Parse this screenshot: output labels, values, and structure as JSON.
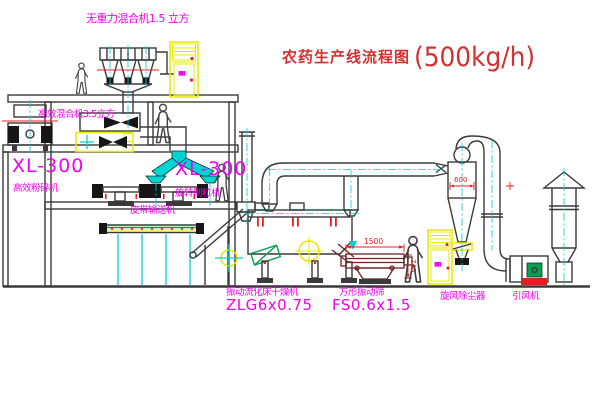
{
  "title": {
    "main": "农药生产线流程图",
    "capacity": "(500kg/h)"
  },
  "labels": {
    "top_mixer": "无重力混合机1.5 立方",
    "second_mixer": "高效混合机3.5立方",
    "pulverizer_model": "XL-300",
    "pulverizer_name": "高效粉碎机",
    "granulator_model": "XL-300",
    "granulator_name": "旋转制粒机",
    "belt_conveyor": "皮带输送机",
    "dryer_name": "振动流化床干燥机",
    "dryer_model": "ZLG6x0.75",
    "screen_name": "方形振动筛",
    "screen_model": "FS0.6x1.5",
    "cyclone_name": "旋风除尘器",
    "fan_name": "引风机"
  },
  "dimensions": {
    "screen_length": "1500",
    "screen_height": "745",
    "cyclone_size": "600"
  },
  "cabinets": {
    "panel_marks": "▮▮▮"
  },
  "colors": {
    "line": "#3a3a3a",
    "label_magenta": "#f000f0",
    "centerline_cyan": "#00d0d0",
    "cabinet_yellow": "#e8e800",
    "dimension_red": "#e02020",
    "motor_green": "#00a050",
    "screen_maroon": "#6e2222",
    "title_red": "#d43030"
  }
}
